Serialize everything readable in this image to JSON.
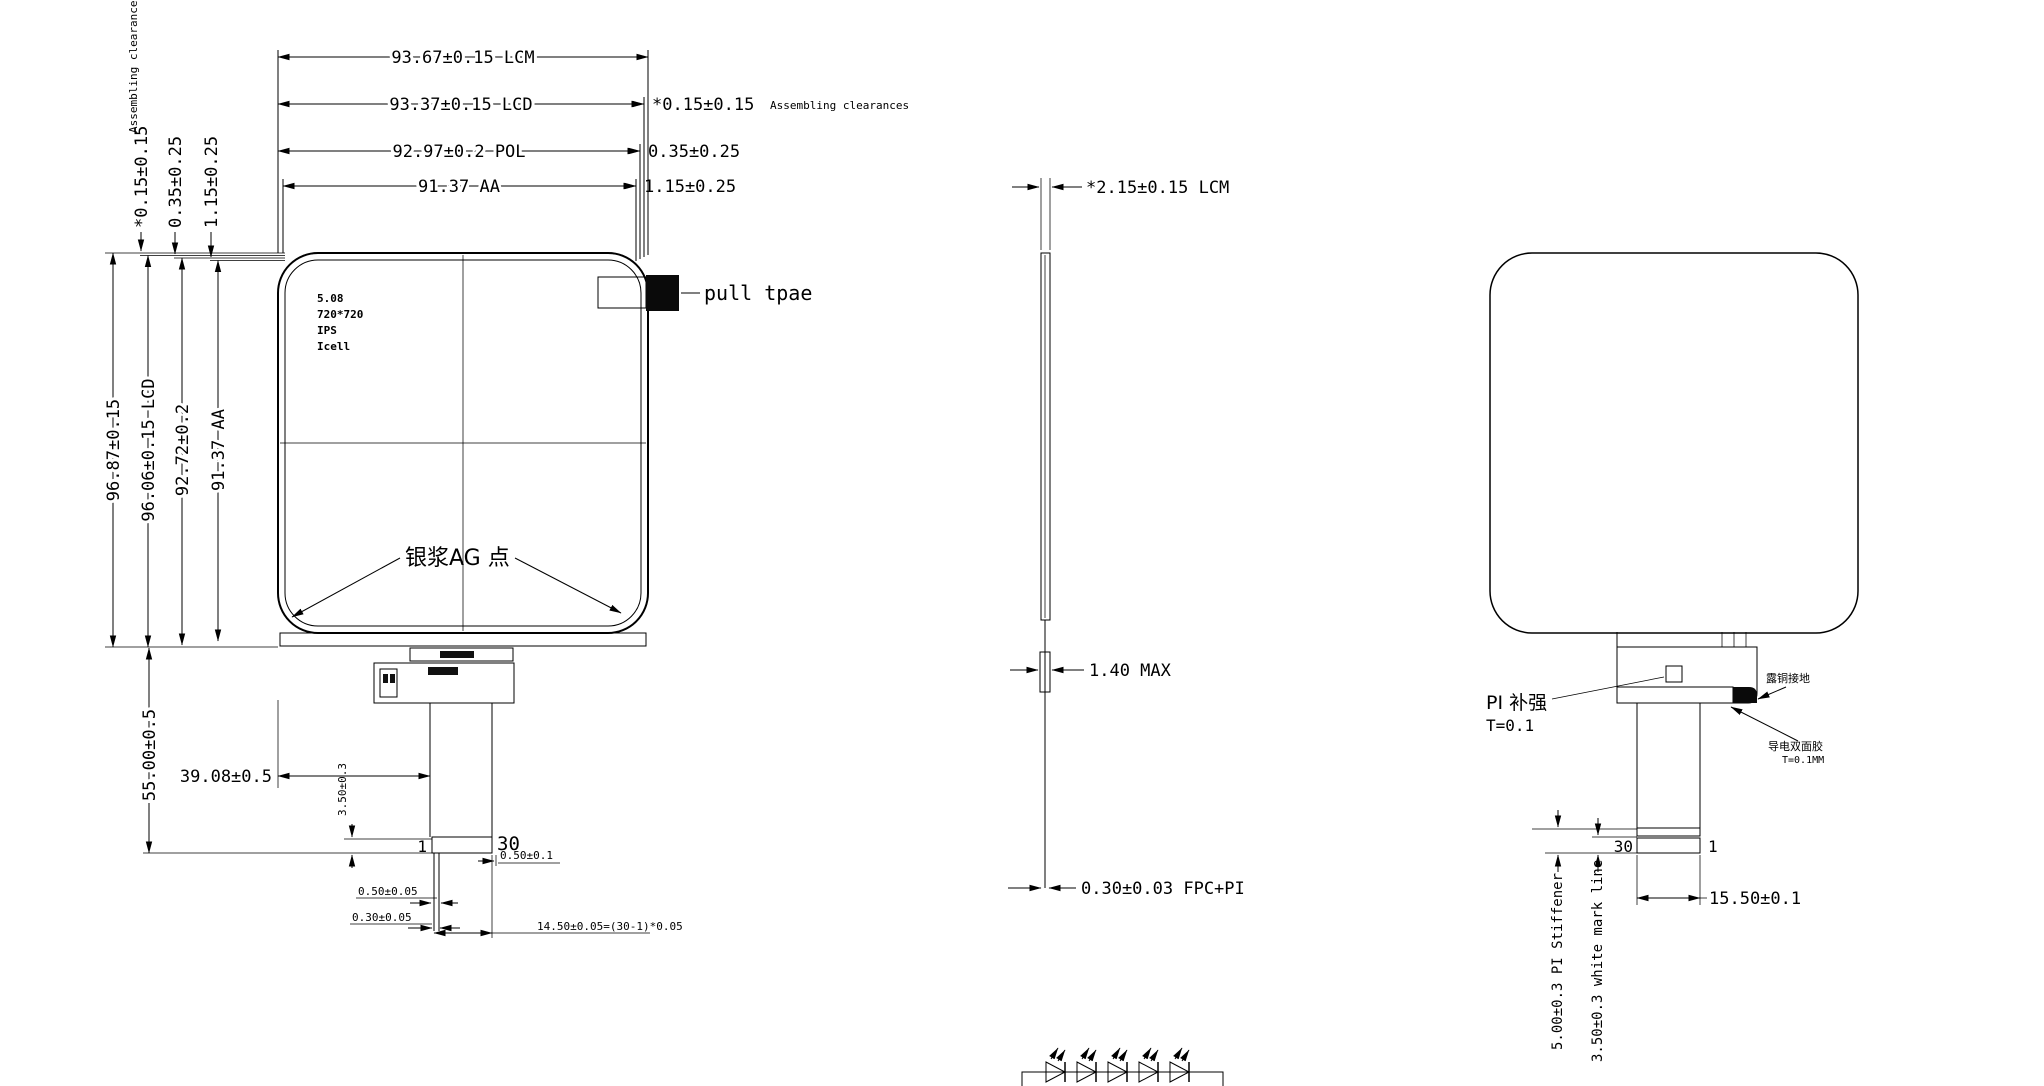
{
  "front": {
    "dim_width_lcm": "93.67±0.15 LCM",
    "dim_width_lcd": "93.37±0.15 LCD",
    "dim_width_pol": "92.97±0.2 POL",
    "dim_width_aa": "91.37 AA",
    "gap_lcm_lcd": "*0.15±0.15",
    "gap_lcd_pol": "0.35±0.25",
    "gap_pol_aa": "1.15±0.25",
    "assembling_note": "Assembling clearances",
    "dim_height_lcm": "96.87±0.15",
    "dim_height_lcd": "96.06±0.15 LCD",
    "dim_height_pol": "92.72±0.2",
    "dim_height_aa": "91.37 AA",
    "spec_lines": [
      "5.08",
      "720*720",
      "IPS",
      "Icell"
    ],
    "pull_tab_label": "pull tpae",
    "silver_dot_label": "银浆AG 点",
    "dim_fpc_length": "55.00±0.5",
    "dim_fpc_offset": "39.08±0.5",
    "dim_mark_gap": "3.50±0.3",
    "pin_one": "1",
    "pin_thirty": "30",
    "dim_end_margin": "0.50±0.1",
    "dim_pin_pitch": "0.50±0.05",
    "dim_pin_width": "0.30±0.05",
    "dim_pin_span": "14.50±0.05=(30-1)*0.05"
  },
  "side": {
    "dim_thickness": "*2.15±0.15 LCM",
    "dim_ic": "1.40 MAX",
    "dim_fpc": "0.30±0.03 FPC+PI"
  },
  "back": {
    "pi_label": "PI 补强",
    "pi_thickness": "T=0.1",
    "copper_label": "露铜接地",
    "tape_label": "导电双面胶",
    "tape_thickness": "T=0.1MM",
    "pin_thirty": "30",
    "pin_one": "1",
    "dim_fpc_width": "15.50±0.1",
    "dim_stiffener": "5.00±0.3 PI Stiffener",
    "dim_mark_line": "3.50±0.3 white mark line"
  }
}
